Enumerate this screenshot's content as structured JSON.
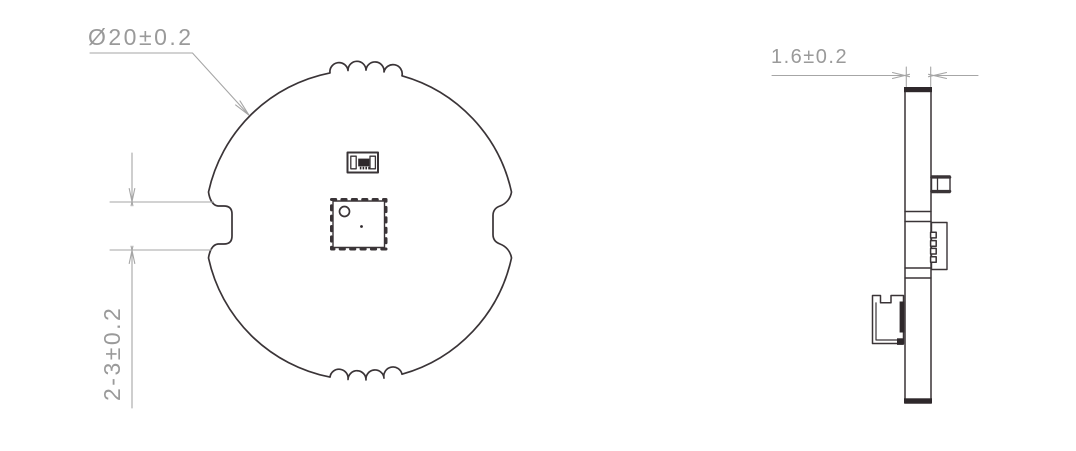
{
  "drawing": {
    "front_view": {
      "diameter_label": "Ø20±0.2",
      "tab_width_label": "2-3±0.2"
    },
    "side_view": {
      "thickness_label": "1.6±0.2"
    },
    "colors": {
      "outline": "#3a3437",
      "fill_dark": "#2e282b",
      "dimension": "#a6a6a6",
      "text": "#9a9a9a",
      "background": "#ffffff"
    }
  }
}
